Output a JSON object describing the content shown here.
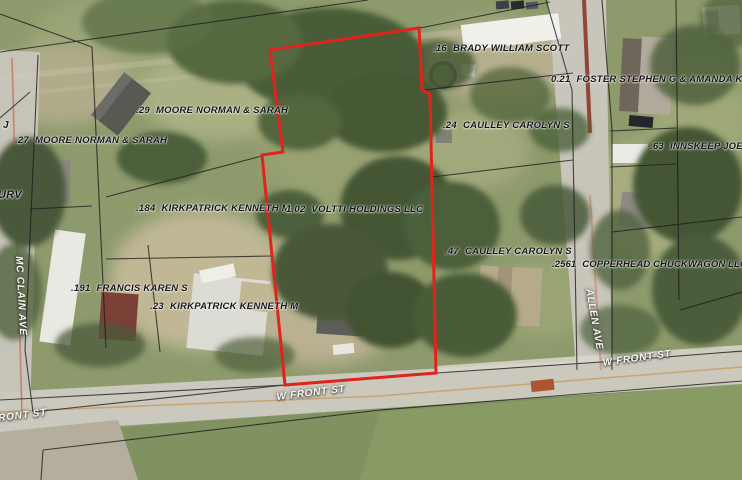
{
  "map": {
    "selected_parcel": {
      "acreage": "1.02",
      "owner": "VOLTTI HOLDINGS LLC",
      "outline_color": "#e1241b"
    },
    "parcels": [
      {
        "acreage": ".16",
        "owner": "BRADY WILLIAM SCOTT"
      },
      {
        "acreage": "0.21",
        "owner": "FOSTER STEPHEN G & AMANDA K"
      },
      {
        "acreage": ".29",
        "owner": "MOORE NORMAN & SARAH"
      },
      {
        "acreage": ".27",
        "owner": "MOORE NORMAN & SARAH"
      },
      {
        "acreage": ".24",
        "owner": "CAULLEY CAROLYN S"
      },
      {
        "acreage": ".63",
        "owner": "INNSKEEP JOE &"
      },
      {
        "acreage": ".184",
        "owner": "KIRKPATRICK KENNETH M"
      },
      {
        "acreage": "1.02",
        "owner": "VOLTTI HOLDINGS LLC"
      },
      {
        "acreage": ".47",
        "owner": "CAULLEY CAROLYN S"
      },
      {
        "acreage": ".2561",
        "owner": "COPPERHEAD CHUCKWAGON LLC"
      },
      {
        "acreage": ".191",
        "owner": "FRANCIS KAREN S"
      },
      {
        "acreage": ".23",
        "owner": "KIRKPATRICK KENNETH M"
      }
    ],
    "streets": {
      "w_front_center": "W FRONT ST",
      "w_front_right": "W FRONT ST",
      "front_partial": "FRONT ST",
      "mc_clain": "MC CLAIN AVE",
      "allen": "ALLEN AVE"
    },
    "fragments": {
      "upper": "J",
      "lower": "URV"
    }
  }
}
